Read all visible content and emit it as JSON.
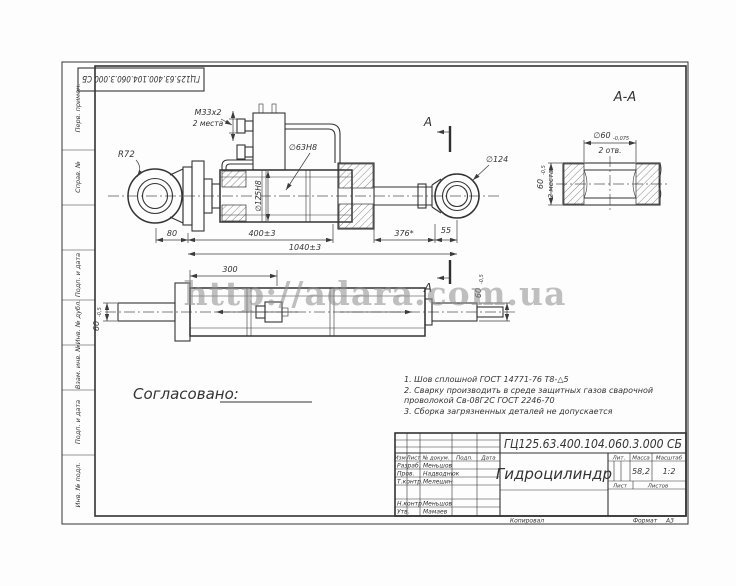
{
  "watermark": "http://adara.com.ua",
  "frame": {
    "doc_number_rotated": "ГЦ125.63.400.104.060.3.000 СБ",
    "margin_labels": {
      "perv_primen": "Перв. примен.",
      "sprav_no": "Справ. №",
      "podp_data_1": "Подп. и дата",
      "inv_dubl": "Инв. № дубл.",
      "vzam_inv": "Взам. инв. №",
      "podp_data_2": "Подп. и дата",
      "inv_podl": "Инв. № подл."
    },
    "copied": "Копировал",
    "format_label": "Формат",
    "format_value": "А3"
  },
  "main_view": {
    "r72": "R72",
    "dim_80": "80",
    "m33": "М33х2",
    "m33_sub": "2 места",
    "d63": "∅63Н8",
    "d125": "∅125Н8",
    "dim_400": "400±3",
    "dim_1040": "1040±3",
    "dim_376": "376*",
    "dim_55": "55",
    "d124": "∅124",
    "section_letter_top": "А",
    "section_letter_bottom": "А"
  },
  "section_view": {
    "title": "А-А",
    "d60": "∅60",
    "d60_tol": "-0,075",
    "d60_sub": "2 отв.",
    "w60": "60",
    "w60_tol": "-0,5",
    "w60_sub": "2 места"
  },
  "bottom_view": {
    "dim_300": "300",
    "dim_60_left": "60",
    "dim_60_left_tol": "-0,5",
    "dim_60_right": "60",
    "dim_60_right_tol": "-0,5"
  },
  "approval_label": "Согласовано:",
  "notes": {
    "line1": "1. Шов сплошной ГОСТ 14771-76 Т8-△5",
    "line2": "2. Сварку  производить  в  среде  защитных  газов  сварочной",
    "line3": "проволокой Св-08Г2С ГОСТ 2246-70",
    "line4": "3. Сборка загрязненных деталей не допускается"
  },
  "title_block": {
    "doc_number": "ГЦ125.63.400.104.060.3.000 СБ",
    "product_name": "Гидроцилиндр",
    "mass": "58,2",
    "scale": "1:2",
    "headers": {
      "izm": "Изм.",
      "list": "Лист",
      "doc": "№ докум.",
      "podp": "Подп.",
      "data": "Дата",
      "lit": "Лит.",
      "massa": "Масса",
      "masshtab": "Масштаб",
      "sheet": "Лист",
      "sheets": "Листов"
    },
    "rows": [
      {
        "role": "Разраб.",
        "name": "Меньшов"
      },
      {
        "role": "Пров.",
        "name": "Надводнюк"
      },
      {
        "role": "Т.контр.",
        "name": "Мелешин"
      },
      {
        "role": "Н.контр.",
        "name": "Меньшов"
      },
      {
        "role": "Утв.",
        "name": "Мамаев"
      }
    ]
  }
}
